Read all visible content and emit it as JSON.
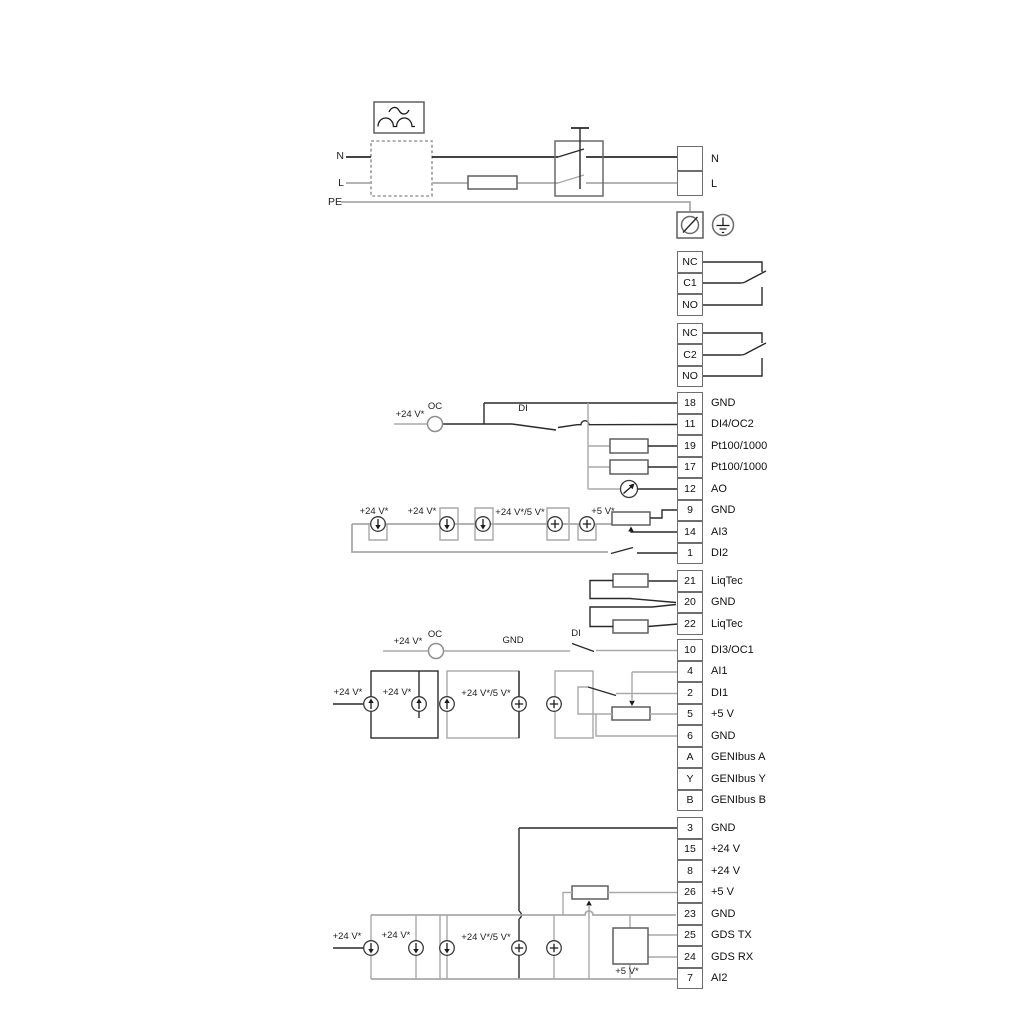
{
  "power": {
    "input_labels": {
      "n": "N",
      "l": "L",
      "pe": "PE"
    },
    "output_terminal": [
      "N",
      "L"
    ]
  },
  "relay1": [
    "NC",
    "C1",
    "NO"
  ],
  "relay2": [
    "NC",
    "C2",
    "NO"
  ],
  "groupA": [
    {
      "id": "18",
      "label": "GND"
    },
    {
      "id": "11",
      "label": "DI4/OC2"
    },
    {
      "id": "19",
      "label": "Pt100/1000"
    },
    {
      "id": "17",
      "label": "Pt100/1000"
    },
    {
      "id": "12",
      "label": "AO"
    },
    {
      "id": "9",
      "label": "GND"
    },
    {
      "id": "14",
      "label": "AI3"
    },
    {
      "id": "1",
      "label": "DI2"
    }
  ],
  "liqtec": [
    {
      "id": "21",
      "label": "LiqTec"
    },
    {
      "id": "20",
      "label": "GND"
    },
    {
      "id": "22",
      "label": "LiqTec"
    }
  ],
  "groupB": [
    {
      "id": "10",
      "label": "DI3/OC1"
    },
    {
      "id": "4",
      "label": "AI1"
    },
    {
      "id": "2",
      "label": "DI1"
    },
    {
      "id": "5",
      "label": "+5 V"
    },
    {
      "id": "6",
      "label": "GND"
    },
    {
      "id": "A",
      "label": "GENIbus A"
    },
    {
      "id": "Y",
      "label": "GENIbus Y"
    },
    {
      "id": "B",
      "label": "GENIbus B"
    }
  ],
  "groupC": [
    {
      "id": "3",
      "label": "GND"
    },
    {
      "id": "15",
      "label": "+24 V"
    },
    {
      "id": "8",
      "label": "+24 V"
    },
    {
      "id": "26",
      "label": "+5 V"
    },
    {
      "id": "23",
      "label": "GND"
    },
    {
      "id": "25",
      "label": "GDS TX"
    },
    {
      "id": "24",
      "label": "GDS RX"
    },
    {
      "id": "7",
      "label": "AI2"
    }
  ],
  "wire_labels": {
    "g1_supply": "+24 V*",
    "g1_oc": "OC",
    "g1_di": "DI",
    "g2_supply1": "+24 V*",
    "g2_supply2": "+24 V*",
    "g2_supply3": "+24 V*/5 V*",
    "g2_supply4": "+5 V*",
    "g3_supply1": "+24 V*",
    "g3_supply2": "+24 V*",
    "g3_supply3": "+24 V*/5 V*",
    "g4_supply": "+24 V*",
    "g4_oc": "OC",
    "g4_gnd": "GND",
    "g4_di": "DI",
    "g5_supply1": "+24 V*",
    "g5_supply2": "+24 V*",
    "g5_supply3": "+24 V*/5 V*",
    "g5_supply4": "+5 V*"
  },
  "colors": {
    "wire_dark": "#2a2a2a",
    "wire_gray": "#a9a9a9",
    "box_border": "#6e6e6e"
  }
}
